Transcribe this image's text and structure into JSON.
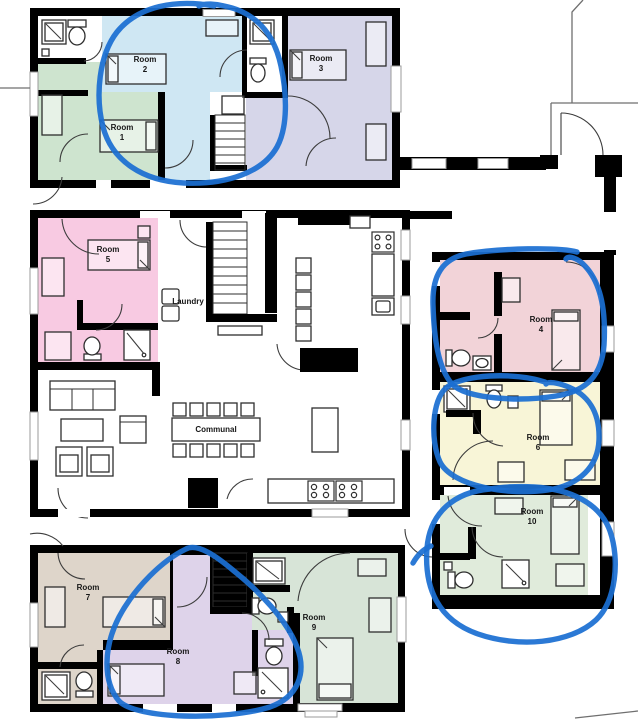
{
  "plan": {
    "type": "floor-plan",
    "pen_color": "#1b6fd2",
    "wall_color": "#000000",
    "background": "#ffffff"
  },
  "rooms": [
    {
      "id": "room-1",
      "name": "Room",
      "number": "1",
      "color": "#cee4cf",
      "circled": false
    },
    {
      "id": "room-2",
      "name": "Room",
      "number": "2",
      "color": "#cfe7f3",
      "circled": true
    },
    {
      "id": "room-3",
      "name": "Room",
      "number": "3",
      "color": "#d6d6e9",
      "circled": false
    },
    {
      "id": "room-4",
      "name": "Room",
      "number": "4",
      "color": "#f2d3d8",
      "circled": true
    },
    {
      "id": "room-5",
      "name": "Room",
      "number": "5",
      "color": "#f8cae2",
      "circled": false
    },
    {
      "id": "room-6",
      "name": "Room",
      "number": "6",
      "color": "#f8f5d7",
      "circled": true
    },
    {
      "id": "room-7",
      "name": "Room",
      "number": "7",
      "color": "#ded5ca",
      "circled": false
    },
    {
      "id": "room-8",
      "name": "Room",
      "number": "8",
      "color": "#ded3ea",
      "circled": true
    },
    {
      "id": "room-9",
      "name": "Room",
      "number": "9",
      "color": "#d7e4d7",
      "circled": false
    },
    {
      "id": "room-10",
      "name": "Room",
      "number": "10",
      "color": "#e0ebdb",
      "circled": true
    }
  ],
  "areas": {
    "laundry": "Laundry",
    "communal": "Communal"
  },
  "annotation": {
    "tool": "blue-pen",
    "color": "#1b6fd2",
    "circled_rooms": [
      "Room 2",
      "Room 4",
      "Room 6",
      "Room 8",
      "Room 10"
    ]
  }
}
